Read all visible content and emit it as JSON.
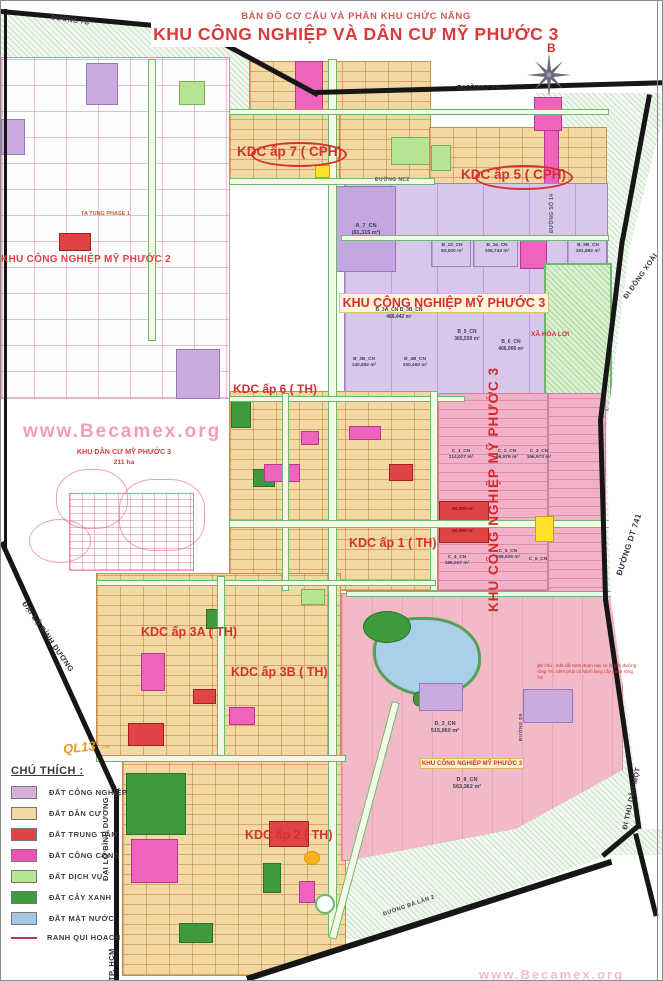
{
  "header": {
    "subtitle": "BẢN ĐỒ CƠ CẤU VÀ PHÂN KHU CHỨC NĂNG",
    "title": "KHU CÔNG NGHIỆP VÀ DÂN CƯ  MỸ PHƯỚC 3"
  },
  "compass": {
    "label": "B"
  },
  "watermark": {
    "main": "www.Becamex.org",
    "bottom": "www.Becamex.org"
  },
  "regions": {
    "mp2": "KHU CÔNG NGHIỆP MỸ PHƯỚC 2",
    "mp3_center": "KHU CÔNG NGHIỆP MỸ PHƯỚC 3",
    "mp3_vertical": "KHU CÔNG NGHIỆP MỸ PHƯỚC 3",
    "mp3_south": "KHU CÔNG NGHIỆP MỸ PHƯỚC 3",
    "kdc_ap7": "KDC ấp 7 ( CPH)",
    "kdc_ap5": "KDC ấp 5 ( CPH)",
    "kdc_ap6": "KDC ấp 6 ( TH)",
    "kdc_ap1": "KDC ấp 1 ( TH)",
    "kdc_ap3a": "KDC ấp 3A ( TH)",
    "kdc_ap3b": "KDC ấp 3B ( TH)",
    "kdc_ap2": "KDC ấp 2 ( TH)",
    "kdc_mp3_name": "KHU DÂN CƯ MỸ PHƯỚC 3",
    "kdc_mp3_area": "211 ha",
    "xa_hoa_loi": "XÃ HÒA LỢI",
    "ta_tung": "TA TUNG PHASE 1",
    "ql13": "QL13 →",
    "note": "ghi chú : mặt cắt ranh đoạn này có lộ giới đường rộng 7m, kèm phải có hành lang cây xanh rộng 7m"
  },
  "streets": {
    "duong_7b_left": "ĐƯỜNG 7B",
    "duong_7b_right": "ĐƯỜNG 7B",
    "duong_nc2": "ĐƯỜNG NC2",
    "duong_so_14": "ĐƯỜNG SỐ 14",
    "duong_dt_741": "ĐƯỜNG DT 741",
    "dai_lo_binh_duong_upper": "ĐẠI LỘ BÌNH DƯƠNG",
    "dai_lo_binh_duong_lower": "ĐẠI LỘ BÌNH DƯƠNG",
    "di_dong_xoai": "ĐI ĐỒNG XOÀI",
    "di_thu_dau_mot": "ĐI THỦ DẦU MỘT",
    "tp_hcm": "TP. HCM",
    "duong_ba_lan_2": "ĐƯỜNG BÀ LĂN 2",
    "duong_d9": "ĐƯỜNG D9"
  },
  "parcels": [
    {
      "text": "A_7_CN\n(81,315 m²)"
    },
    {
      "text": "B_10_CN\n83,000 m²"
    },
    {
      "text": "B_16_CN\n105,743 m²"
    },
    {
      "text": "B_9B_CN\n101,882 m²"
    },
    {
      "text": "B_3A_CN  B_3B_CN\n486,442 m²"
    },
    {
      "text": "B_5_CN\n365,559 m²"
    },
    {
      "text": "B_6_CN\n406,906 m²"
    },
    {
      "text": "B_3B_CN\n140,892 m²"
    },
    {
      "text": "B_4B_CN\n150,460 m²"
    },
    {
      "text": "C_1_CN\n214,027 m²"
    },
    {
      "text": "C_2_CN\n96,576 m²"
    },
    {
      "text": "C_3_CN\n196,973 m²"
    },
    {
      "text": "C_4_CN\n186,027 m²"
    },
    {
      "text": "C_5_CN\n196,925 m²"
    },
    {
      "text": "C_6_CN"
    },
    {
      "text": "D_3_CN\n515,060 m²"
    },
    {
      "text": "D_8_CN\n563,362 m²"
    },
    {
      "text": "50,000 m²"
    },
    {
      "text": "50,000 m²"
    }
  ],
  "legend": {
    "title": "CHÚ THÍCH :",
    "items": [
      {
        "label": "ĐẤT CÔNG NGHIỆP",
        "color": "#d9aed9"
      },
      {
        "label": "ĐẤT DÂN CƯ",
        "color": "#f2d8a4"
      },
      {
        "label": "ĐẤT TRUNG TÂM",
        "color": "#e04444"
      },
      {
        "label": "ĐẤT CÔNG CỘNG",
        "color": "#ee50b4"
      },
      {
        "label": "ĐẤT DỊCH VỤ",
        "color": "#b4e494"
      },
      {
        "label": "ĐẤT CÂY XANH",
        "color": "#3d9b3d"
      },
      {
        "label": "ĐẤT MẶT NƯỚC",
        "color": "#a6c8e8"
      },
      {
        "label": "RANH QUI HOẠCH",
        "color": "#c03070",
        "type": "line"
      }
    ]
  }
}
